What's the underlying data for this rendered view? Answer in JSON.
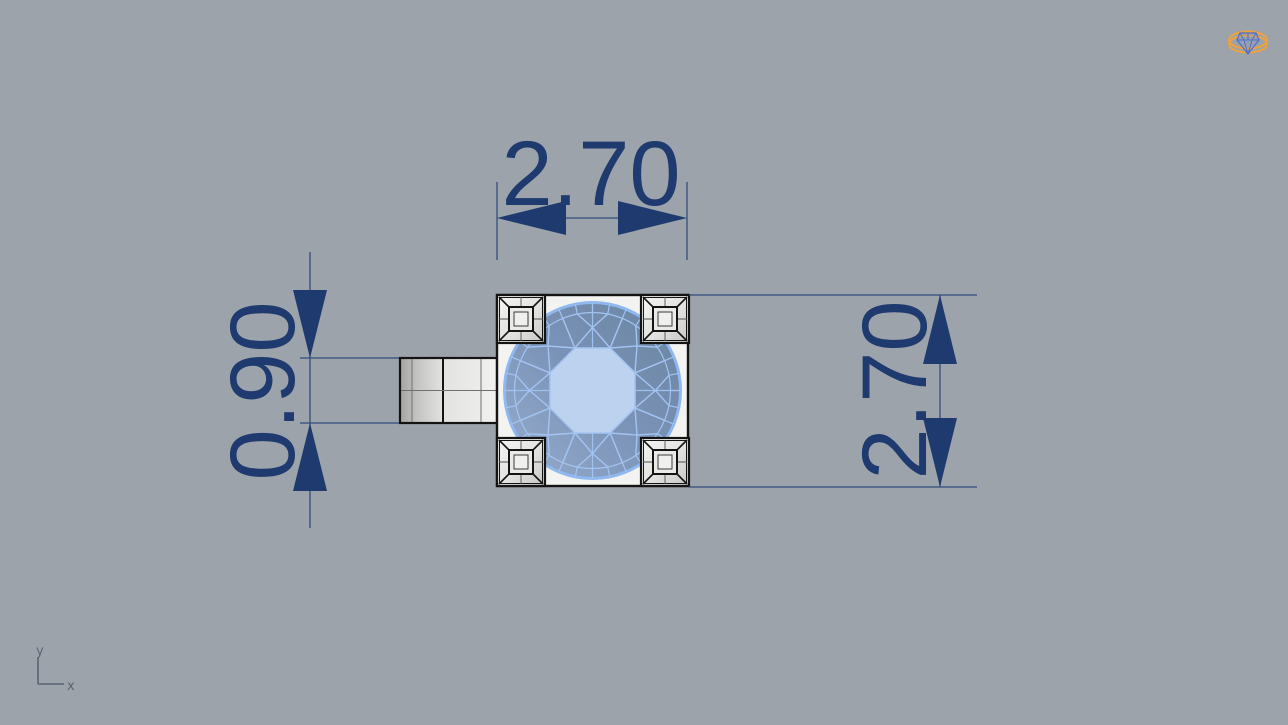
{
  "viewport": {
    "background_color": "#9da3ab",
    "annotation_color": "#1e3a6e",
    "dimensions": [
      {
        "id": "bezel-width-top",
        "value": "2.70",
        "orientation": "horizontal"
      },
      {
        "id": "shank-width-left",
        "value": "0.90",
        "orientation": "vertical"
      },
      {
        "id": "bezel-height-right",
        "value": "2.70",
        "orientation": "vertical"
      }
    ],
    "axis_indicator": {
      "x_label": "x",
      "y_label": "y"
    },
    "logo": {
      "icon": "ring-with-diamond-logo-icon",
      "ring_color": "#f0a23c",
      "gem_color": "#4f6fc5"
    },
    "model": {
      "stone_body_color": "#7b93b7",
      "stone_table_color": "#bdd2ee",
      "stone_facet_line_color": "#a3c4f2",
      "metal_color": "#f3f3f1",
      "outline_color": "#141414"
    }
  }
}
